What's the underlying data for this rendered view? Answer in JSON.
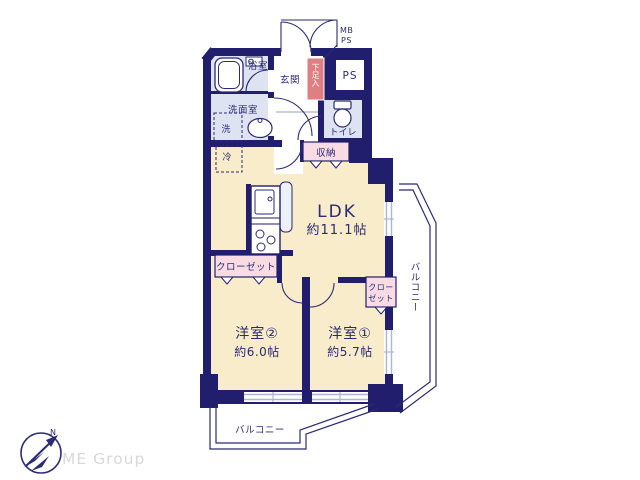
{
  "meta": {
    "kind": "apartment-floorplan"
  },
  "colors": {
    "wall": "#221e6e",
    "room_cream": "#f9ecca",
    "wet_lavender": "#dee3f2",
    "closet_pink": "#f9dce3",
    "shoebox_red": "#df7f84",
    "window_line": "#aab5d9",
    "label_navy": "#2b2a74",
    "brand_gray": "#d9d9d9"
  },
  "labels": {
    "bathroom": "浴室",
    "entrance": "玄関",
    "meter_box": "MB",
    "pipe_shaft_top": "PS",
    "shoe_box": "下足入",
    "pipe_shaft": "PS",
    "washroom": "洗面室",
    "washer": "洗",
    "toilet": "トイレ",
    "storage": "収納",
    "fridge": "冷",
    "ldk": "LDK",
    "ldk_size": "約11.1帖",
    "closet_main": "クローゼット",
    "closet_small_line1": "クロー",
    "closet_small_line2": "ゼット",
    "balcony_side": "バルコニー",
    "room2": "洋室②",
    "room2_size": "約6.0帖",
    "room1": "洋室①",
    "room1_size": "約5.7帖",
    "balcony_bottom": "バルコニー",
    "compass_north": "N",
    "brand": "ME Group"
  }
}
